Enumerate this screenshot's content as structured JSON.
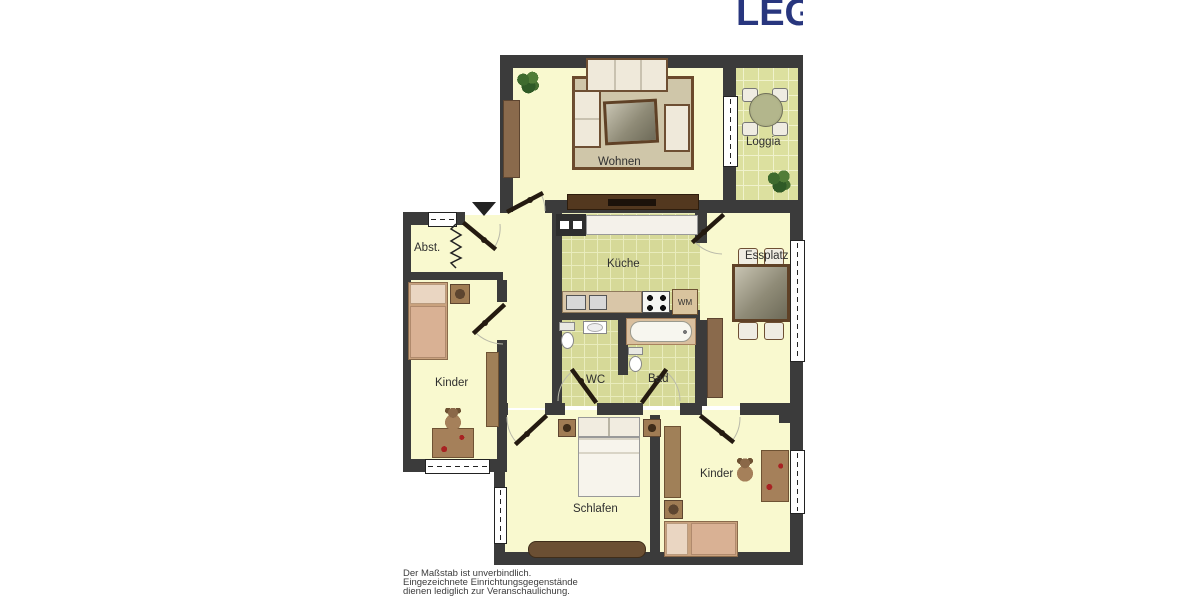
{
  "logo": {
    "text": "LEG",
    "color": "#28367e"
  },
  "plan": {
    "rooms": [
      {
        "id": "wohnen",
        "label": "Wohnen"
      },
      {
        "id": "loggia",
        "label": "Loggia"
      },
      {
        "id": "abstellraum",
        "label": "Abst."
      },
      {
        "id": "kueche",
        "label": "Küche"
      },
      {
        "id": "essplatz",
        "label": "Essplatz"
      },
      {
        "id": "kinder-links",
        "label": "Kinder"
      },
      {
        "id": "wc",
        "label": "WC"
      },
      {
        "id": "bad",
        "label": "Bad"
      },
      {
        "id": "schlafen",
        "label": "Schlafen"
      },
      {
        "id": "kinder-rechts",
        "label": "Kinder"
      }
    ],
    "appliances": {
      "washing_machine_label": "WM"
    },
    "symbols": [
      "entrance-arrow",
      "door-swing",
      "zigzag-partition",
      "window",
      "plant",
      "teddy-bear"
    ]
  },
  "footer": {
    "disclaimer_lines": [
      "Der Maßstab ist unverbindlich.",
      "Eingezeichnete Einrichtungsgegenstände",
      "dienen lediglich zur Veranschaulichung."
    ]
  },
  "colors": {
    "wall": "#3b3b3b",
    "floor": "#f9f9cf",
    "tile_green": "#d6d998",
    "logo_blue": "#28367e"
  }
}
